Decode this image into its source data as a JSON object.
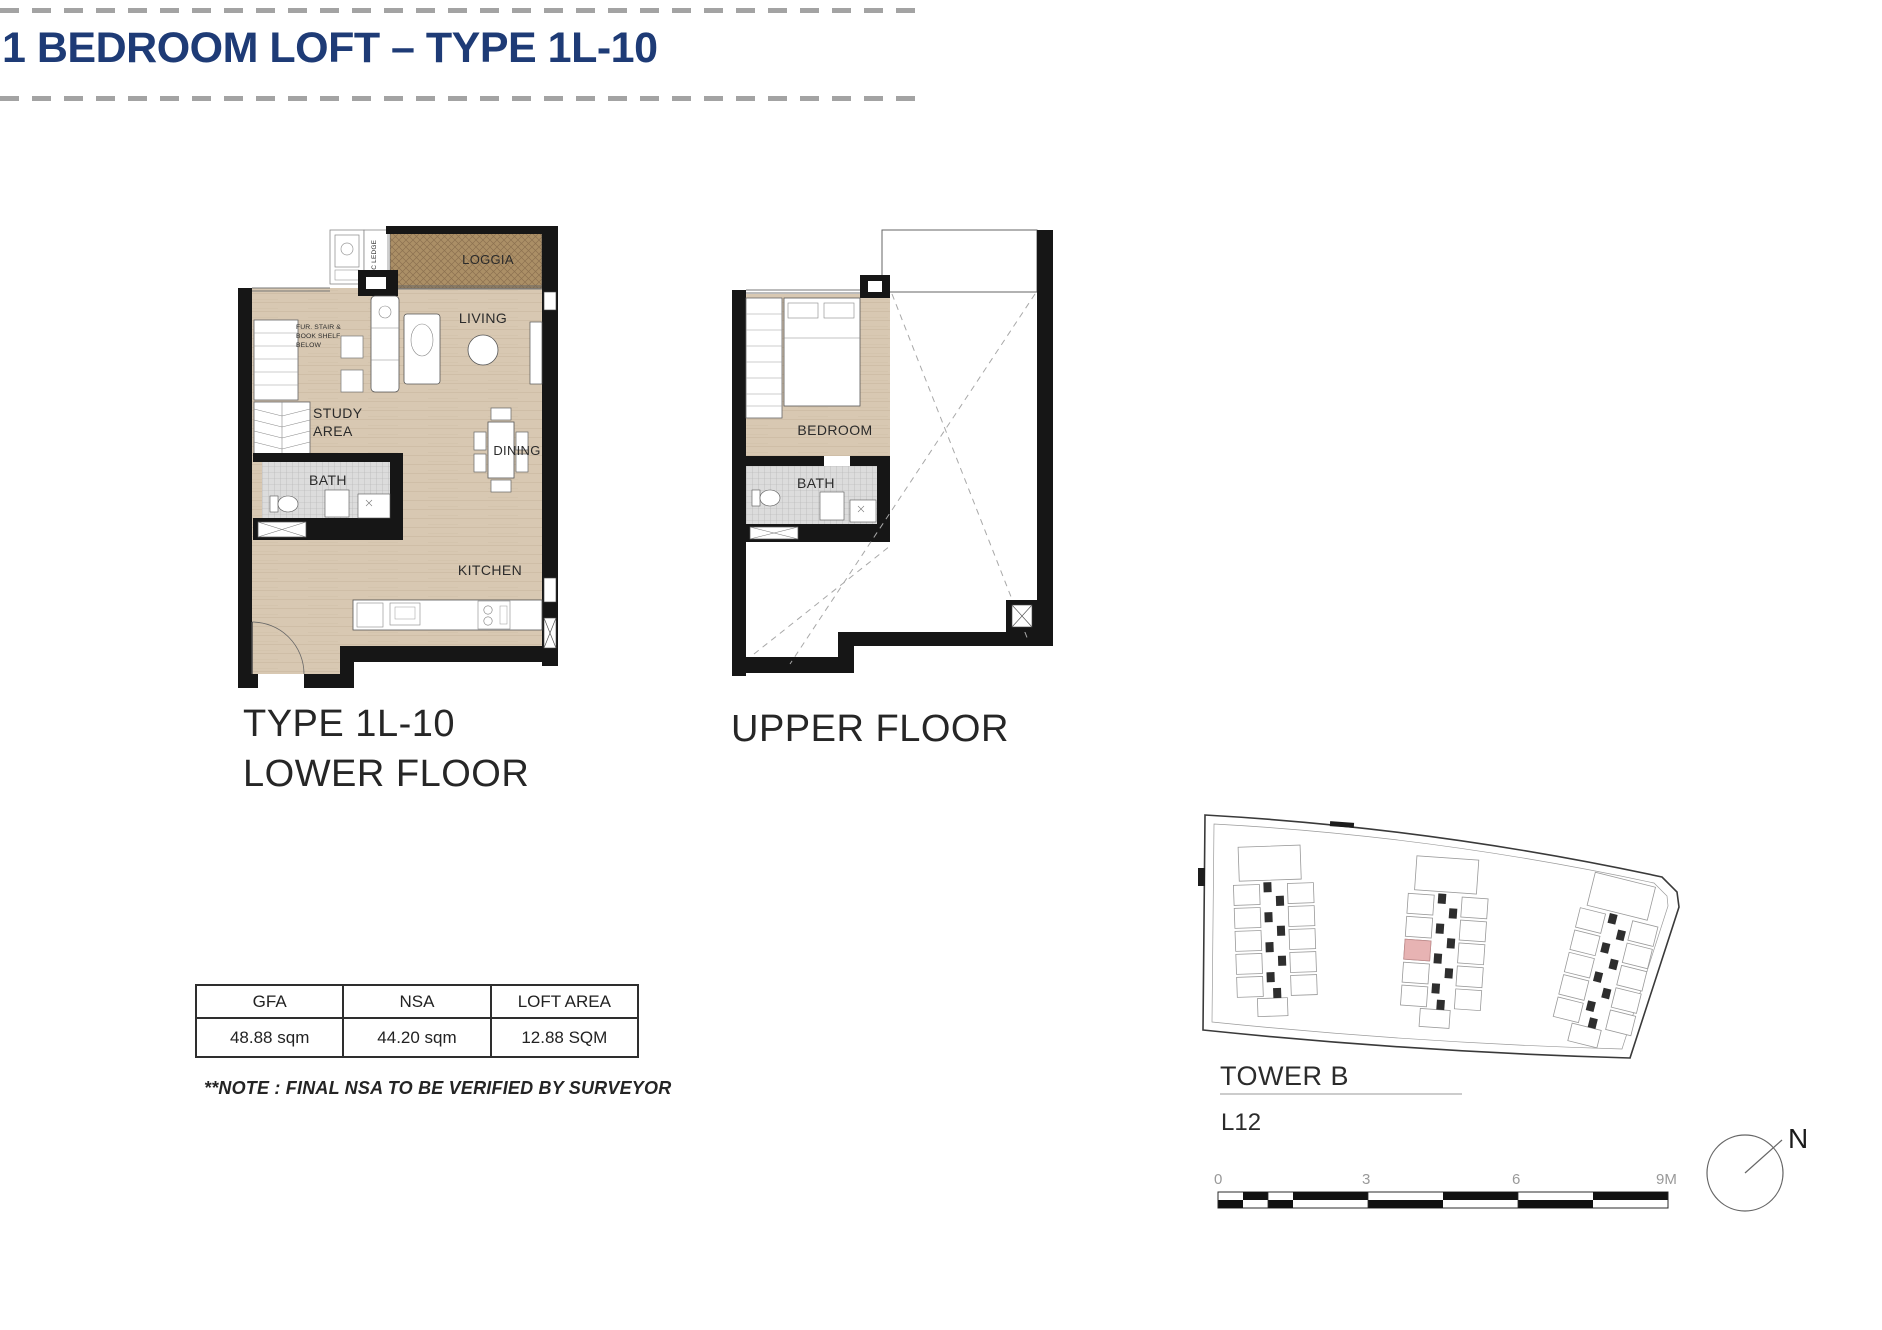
{
  "header": {
    "title": "1 BEDROOM LOFT – TYPE 1L-10"
  },
  "lower_plan": {
    "caption_line1": "TYPE 1L-10",
    "caption_line2": "LOWER FLOOR",
    "labels": {
      "loggia": "LOGGIA",
      "ac_ledge": "AC LEDGE",
      "living": "LIVING",
      "study_line1": "STUDY",
      "study_line2": "AREA",
      "bath": "BATH",
      "dining": "DINING",
      "kitchen": "KITCHEN",
      "stair_note_line1": "FUR. STAIR &",
      "stair_note_line2": "BOOK SHELF",
      "stair_note_line3": "BELOW"
    }
  },
  "upper_plan": {
    "caption": "UPPER FLOOR",
    "labels": {
      "bedroom": "BEDROOM",
      "bath": "BATH"
    }
  },
  "area_table": {
    "headers": [
      "GFA",
      "NSA",
      "LOFT AREA"
    ],
    "values": [
      "48.88 sqm",
      "44.20 sqm",
      "12.88 SQM"
    ]
  },
  "note": "**NOTE : FINAL NSA TO BE VERIFIED BY SURVEYOR",
  "keyplan": {
    "tower": "TOWER B",
    "level": "L12",
    "scale_ticks": [
      "0",
      "3",
      "6",
      "9M"
    ],
    "compass_north": "N"
  },
  "colors": {
    "accent_navy": "#1e3b76",
    "floor_beige": "#d8c8b2",
    "loggia_brown": "#ab8f66",
    "highlight_pink": "#e7b3b3",
    "wall_black": "#161616"
  }
}
